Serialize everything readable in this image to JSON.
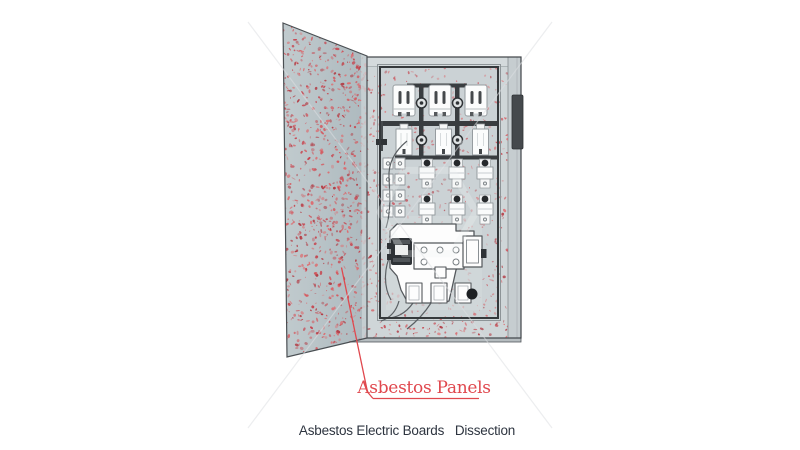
{
  "annotation": {
    "label": "Asbestos Panels",
    "color": "#e0484e"
  },
  "caption": {
    "text": "Asbestos Electric Boards   Dissection",
    "color": "#2e3540"
  },
  "illustration": {
    "door": {
      "name": "asbestos-door-panel",
      "base_color": "#b7c2c7"
    },
    "cabinet": {
      "front_color": "#cfd6d8",
      "back_panel_color": "#cbd2d5",
      "handle_color": "#45494d",
      "busbar_color": "#393d40"
    },
    "speckle_palette": [
      "#c7414b",
      "#d4595f",
      "#b23841",
      "#dd6b6f"
    ]
  }
}
